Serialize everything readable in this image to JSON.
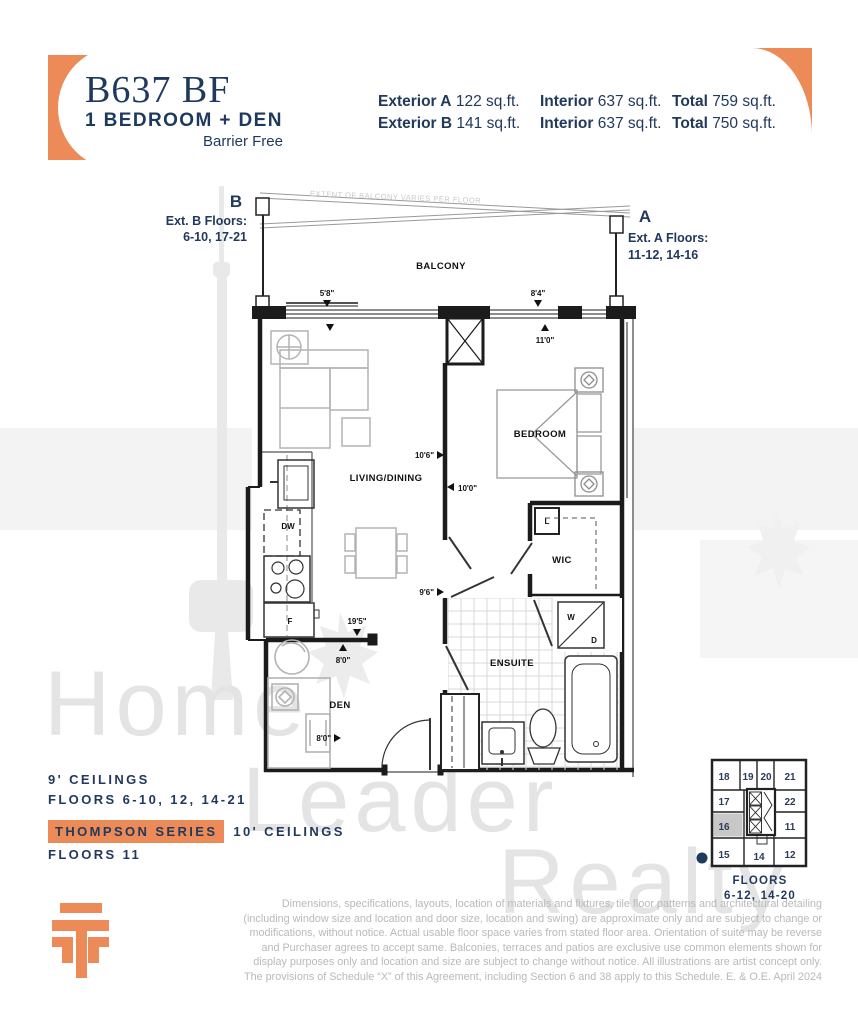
{
  "header": {
    "unit_code": "B637 BF",
    "unit_type": "1 BEDROOM + DEN",
    "unit_sub": "Barrier Free",
    "stats": [
      {
        "ext_label": "Exterior A",
        "ext_value": "122 sq.ft.",
        "int_label": "Interior",
        "int_value": "637 sq.ft.",
        "tot_label": "Total",
        "tot_value": "759 sq.ft."
      },
      {
        "ext_label": "Exterior B",
        "ext_value": "141 sq.ft.",
        "int_label": "Interior",
        "int_value": "637 sq.ft.",
        "tot_label": "Total",
        "tot_value": "750 sq.ft."
      }
    ]
  },
  "plan": {
    "note": "EXTENT OF BALCONY VARIES PER FLOOR",
    "marker_b": {
      "letter": "B",
      "line1": "Ext. B Floors:",
      "line2": "6-10, 17-21"
    },
    "marker_a": {
      "letter": "A",
      "line1": "Ext. A Floors:",
      "line2": "11-12, 14-16"
    },
    "rooms": {
      "balcony": "BALCONY",
      "living": "LIVING/DINING",
      "bedroom": "BEDROOM",
      "wic": "WIC",
      "ensuite": "ENSUITE",
      "den": "DEN"
    },
    "appliances": {
      "dw": "DW",
      "f": "F",
      "l": "L",
      "w": "W",
      "d": "D"
    },
    "dims": {
      "d58": "5'8\"",
      "d84": "8'4\"",
      "d110": "11'0\"",
      "d106": "10'6\"",
      "d100": "10'0\"",
      "d96": "9'6\"",
      "d195": "19'5\"",
      "d80a": "8'0\"",
      "d80b": "8'0\""
    }
  },
  "ceilings": {
    "line1": "9' CEILINGS",
    "line2": "FLOORS 6-10, 12, 14-21",
    "badge": "THOMPSON SERIES",
    "line3": "10' CEILINGS",
    "line4": "FLOORS 11"
  },
  "keyplan": {
    "units": [
      "18",
      "19",
      "20",
      "21",
      "17",
      "22",
      "16",
      "11",
      "15",
      "14",
      "12"
    ],
    "highlighted": "16",
    "caption1": "FLOORS",
    "caption2": "6-12, 14-20"
  },
  "watermark": {
    "line1": "Home",
    "line2": "Leader",
    "line3": "Realty"
  },
  "disclaimer": {
    "lines": [
      "Dimensions, specifications, layouts, location of materials and fixtures, tile floor patterns and architectural detailing",
      "(including window size and location and door size, location and swing) are approximate only and are subject to change or",
      "modifications, without notice. Actual usable floor space varies from stated floor area. Orientation of suite may be reverse",
      "and Purchaser agrees to accept same. Balconies, terraces and patios are exclusive use common elements shown for",
      "display purposes only and location and size are subject to change without notice. All illustrations are artist concept only.",
      "The provisions of Schedule “X” of this Agreement, including Section 6 and 38 apply to this Schedule. E. & O.E. April 2024"
    ]
  },
  "colors": {
    "navy": "#21395c",
    "orange": "#ec8a58",
    "watermark_gray": "#e4e4e4"
  }
}
